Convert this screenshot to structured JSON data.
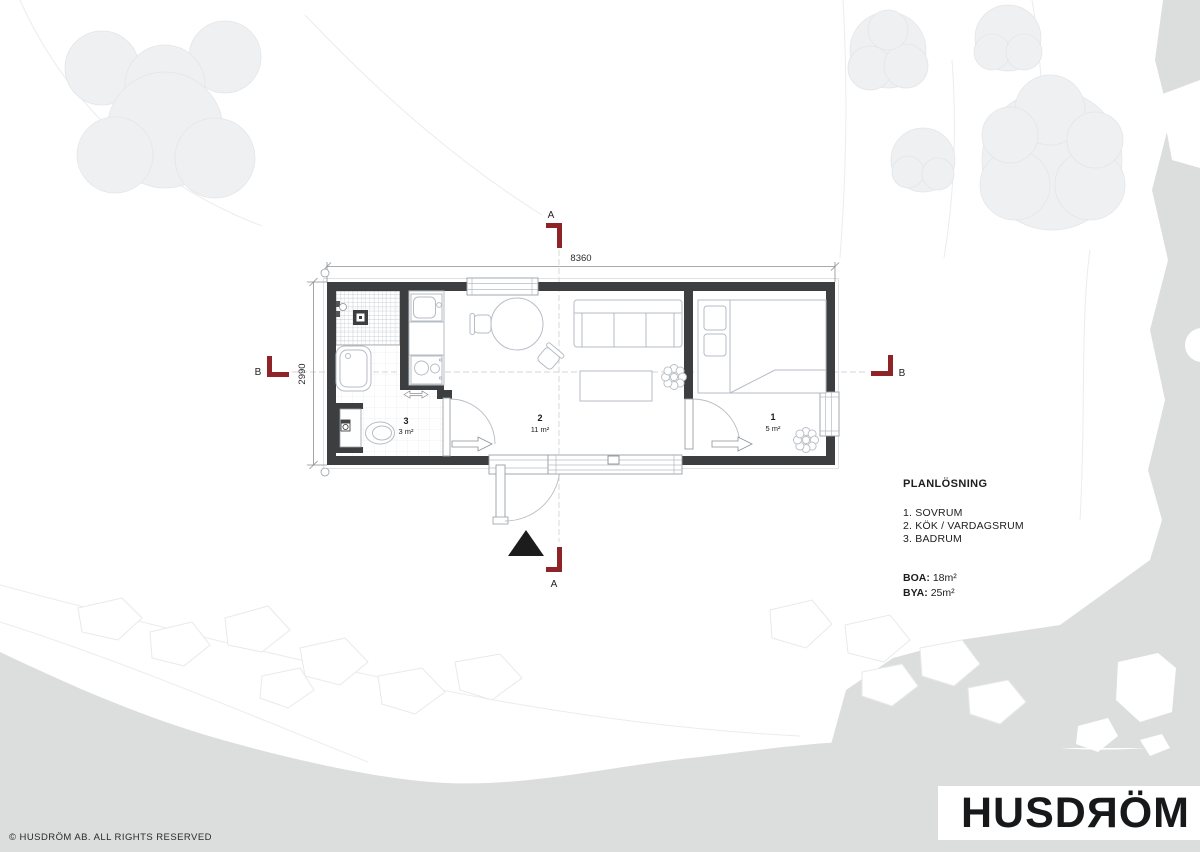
{
  "plan": {
    "dim_width": "8360",
    "dim_height": "2990",
    "marker_a": "A",
    "marker_b": "B",
    "rooms": [
      {
        "number": "1",
        "area": "5 m²"
      },
      {
        "number": "2",
        "area": "11 m²"
      },
      {
        "number": "3",
        "area": "3 m²"
      }
    ]
  },
  "legend": {
    "title": "PLANLÖSNING",
    "items": [
      "1. SOVRUM",
      "2. KÖK / VARDAGSRUM",
      "3. BADRUM"
    ],
    "boa": {
      "label": "BOA:",
      "value": "18m²"
    },
    "bya": {
      "label": "BYA:",
      "value": "25m²"
    }
  },
  "branding": {
    "logo": "HUSDЯÖM",
    "copyright": "© HUSDRÖM AB. ALL RIGHTS RESERVED"
  },
  "colors": {
    "marker_red": "#8e2428",
    "wall_dark": "#3c3e40",
    "terrain_gray": "#dcdddd",
    "tree_gray": "#eef0f2"
  }
}
